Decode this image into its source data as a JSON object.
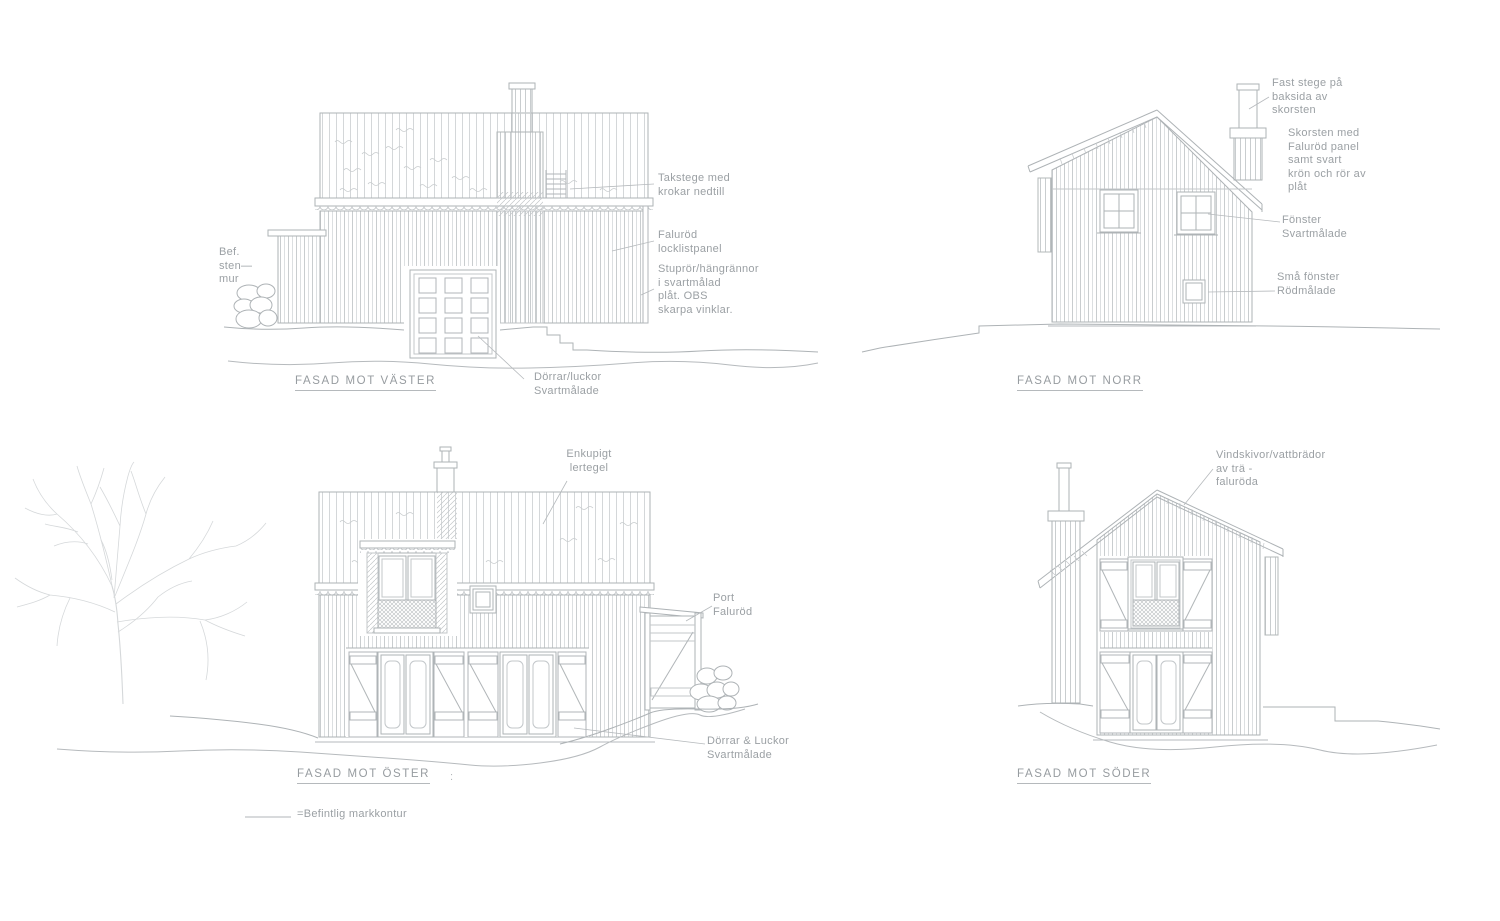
{
  "sheet": {
    "background": "#ffffff",
    "line_color": "#aeb3b6",
    "line_color_faint": "#cdd1d3",
    "text_color": "#9ba0a4"
  },
  "legend": {
    "label": "=Befintlig markkontur"
  },
  "elevations": {
    "vaster": {
      "title": "FASAD MOT VÄSTER",
      "annotations": {
        "bef_stenmur": "Bef.\nsten—\nmur",
        "takstege": "Takstege med\nkrokar nedtill",
        "panel": "Faluröd\nlocklistpanel",
        "stupror": "Stuprör/hängrännor\ni svartmålad\nplåt. OBS\nskarpa vinklar.",
        "dorrar": "Dörrar/luckor\nSvartmålade"
      }
    },
    "norr": {
      "title": "FASAD MOT NORR",
      "annotations": {
        "fast_stege": "Fast stege på\nbaksida av\nskorsten",
        "skorsten": "Skorsten med\nFaluröd panel\nsamt svart\nkrön och rör av\nplåt",
        "fonster": "Fönster\nSvartmålade",
        "sma_fonster": "Små fönster\nRödmålade"
      }
    },
    "oster": {
      "title": "FASAD MOT ÖSTER",
      "title_suffix": ":",
      "annotations": {
        "tegel": "Enkupigt\nlertegel",
        "port": "Port\nFaluröd",
        "dorrar": "Dörrar & Luckor\nSvartmålade"
      }
    },
    "soder": {
      "title": "FASAD MOT SÖDER",
      "annotations": {
        "vindskivor": "Vindskivor/vattbrädor\nav trä -\nfaluröda"
      }
    }
  }
}
